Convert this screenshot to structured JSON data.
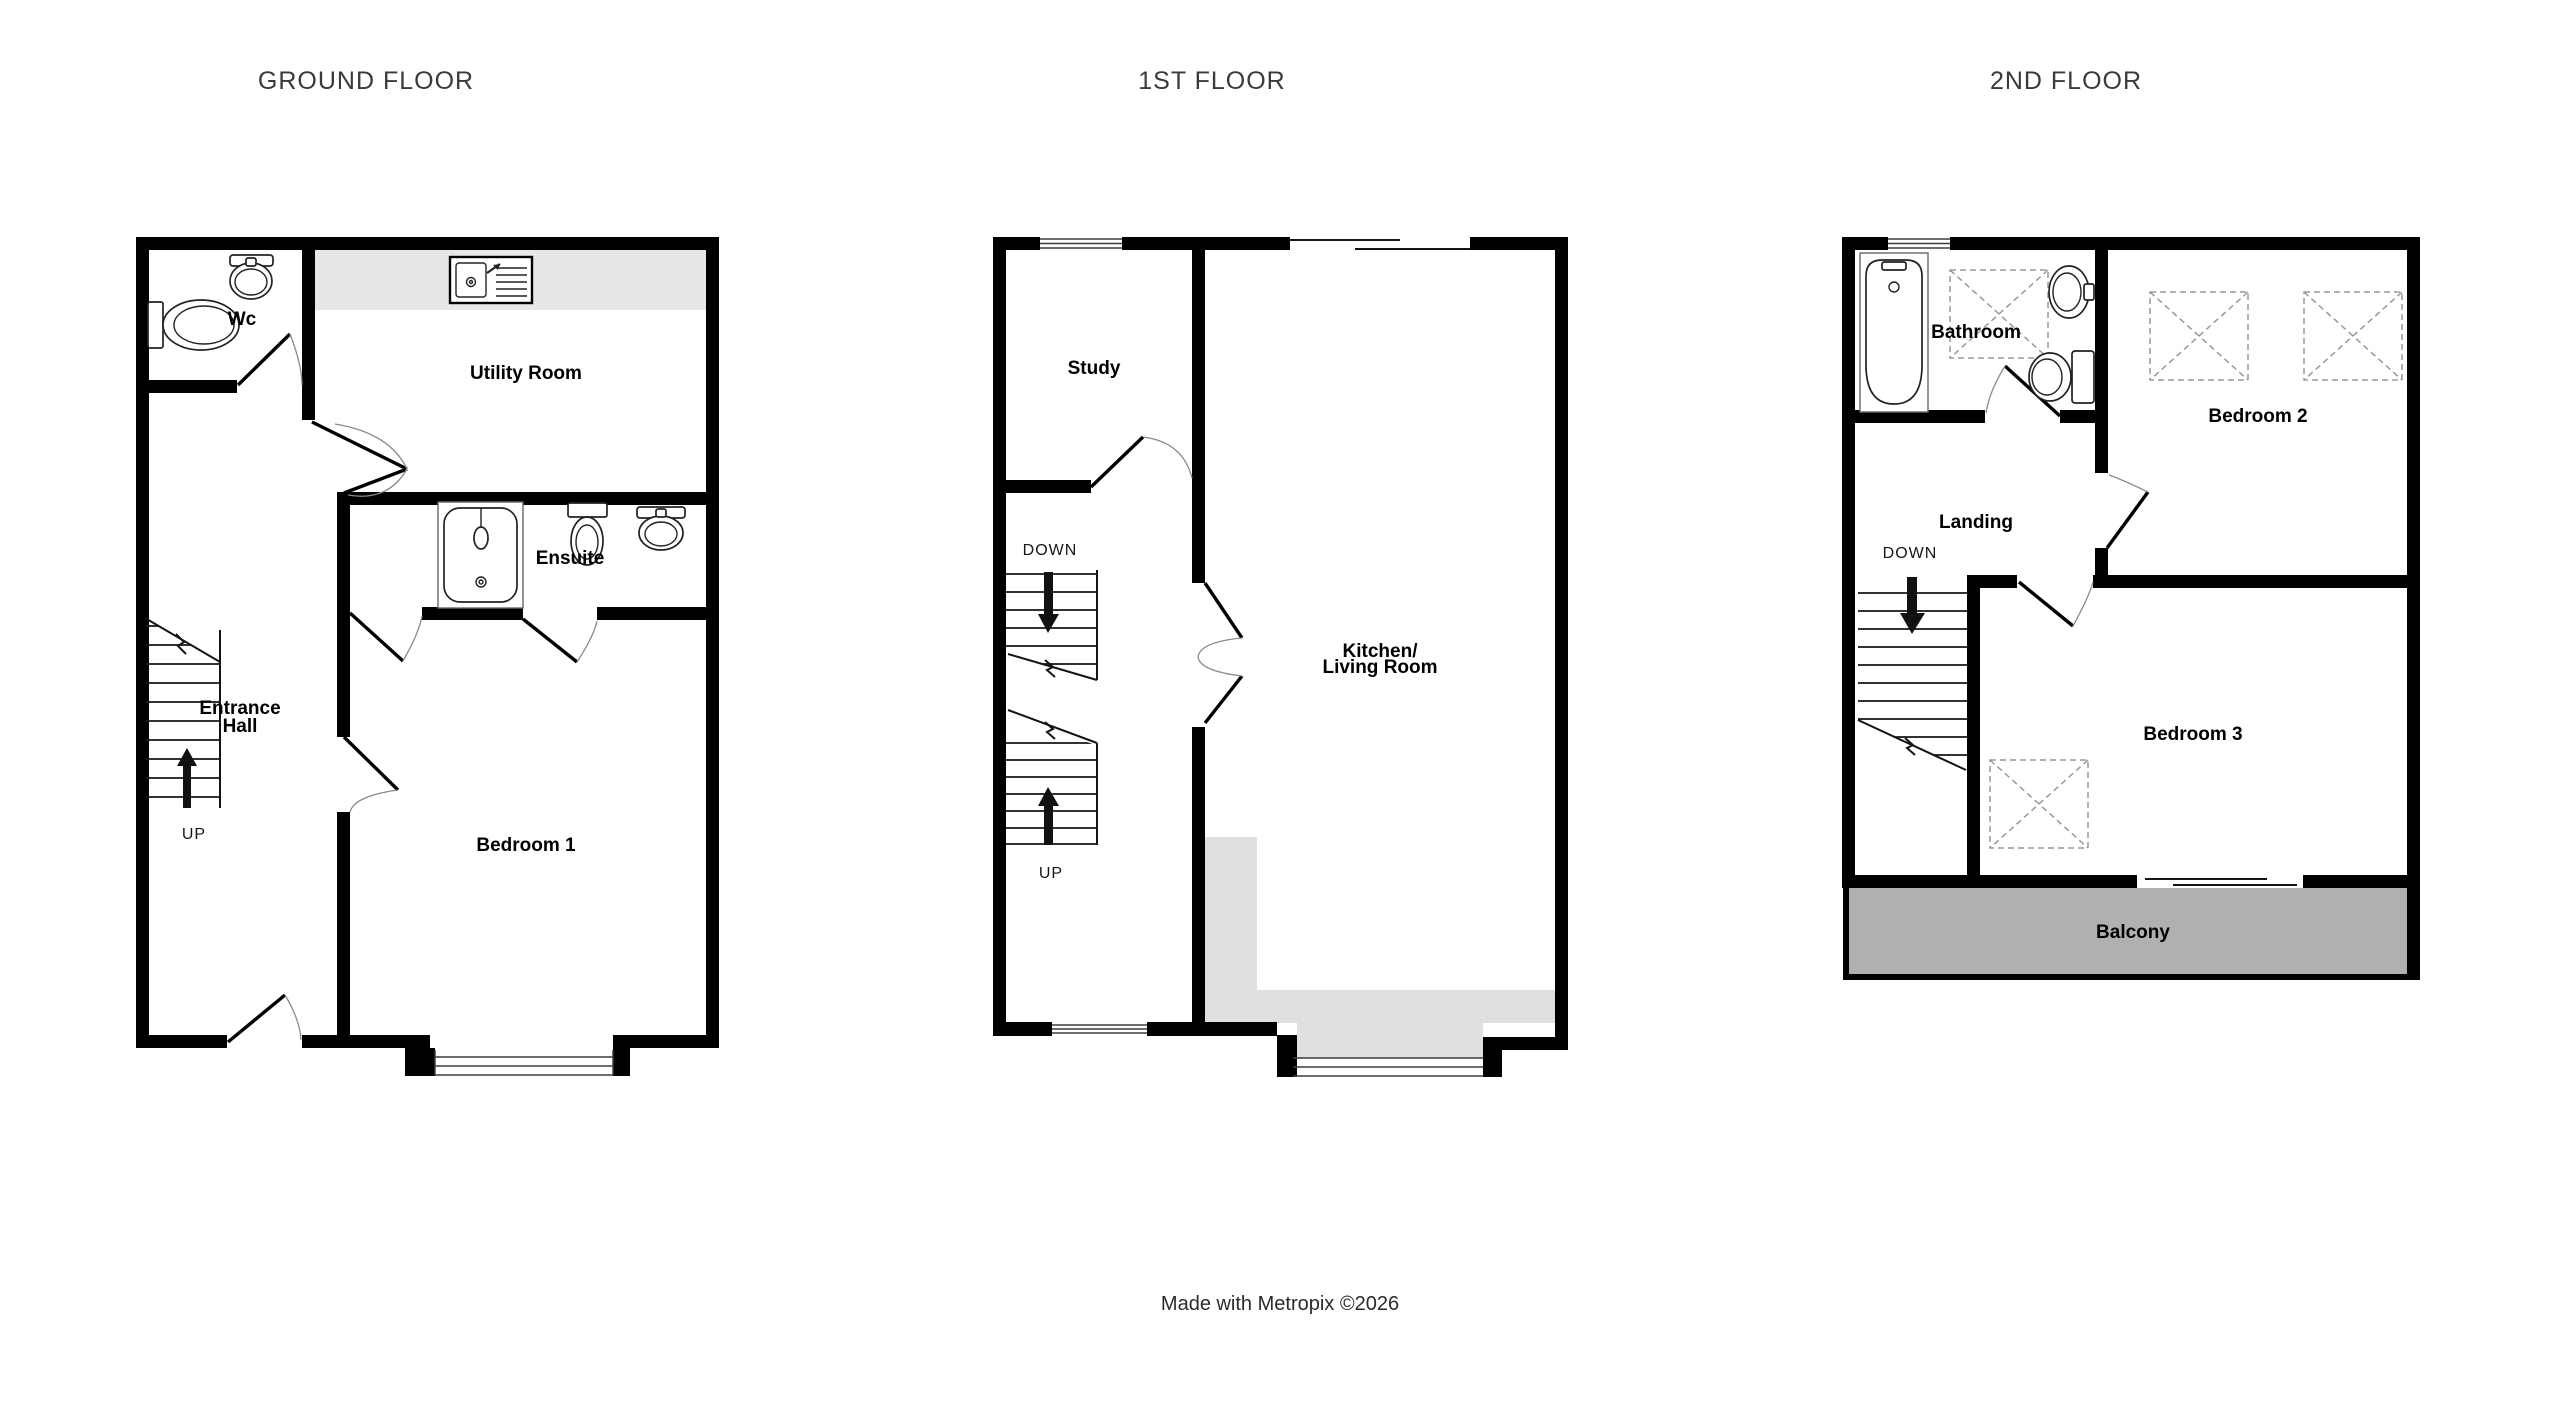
{
  "titles": {
    "ground": "GROUND FLOOR",
    "first": "1ST FLOOR",
    "second": "2ND FLOOR"
  },
  "footer": {
    "text": "Made with Metropix ©2026"
  },
  "ground_floor": {
    "rooms": {
      "wc": "Wc",
      "utility": "Utility Room",
      "ensuite": "Ensuite",
      "entrance_line1": "Entrance",
      "entrance_line2": "Hall",
      "bedroom1": "Bedroom 1"
    },
    "stairs": {
      "up": "UP"
    }
  },
  "first_floor": {
    "rooms": {
      "study": "Study",
      "kitchen_line1": "Kitchen/",
      "kitchen_line2": "Living Room"
    },
    "stairs": {
      "down": "DOWN",
      "up": "UP"
    }
  },
  "second_floor": {
    "rooms": {
      "bathroom": "Bathroom",
      "bedroom2": "Bedroom 2",
      "landing": "Landing",
      "bedroom3": "Bedroom 3",
      "balcony": "Balcony"
    },
    "stairs": {
      "down": "DOWN"
    }
  },
  "colors": {
    "wall": "#000000",
    "counter": "#e7e7e7",
    "kitchenArea": "#e0e0e0",
    "balcony": "#b0b0b0",
    "fixture": "#222222",
    "dash": "#999999",
    "labelColor": "#000000",
    "titleColor": "#3a3a3a",
    "arrowColor": "#111111"
  }
}
